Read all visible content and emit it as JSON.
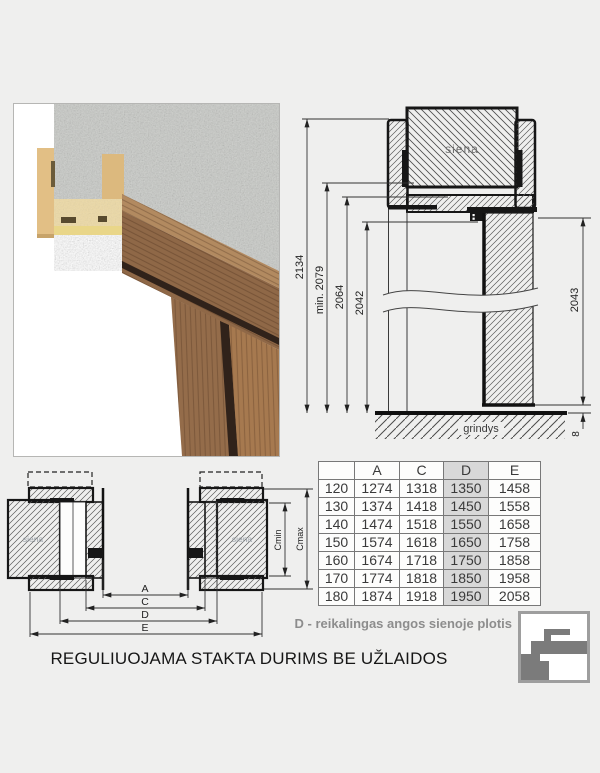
{
  "page": {
    "background": "#efefee",
    "title": "REGULIUOJAMA STAKTA DURIMS BE UŽLAIDOS",
    "note": "D - reikalingas angos sienoje plotis"
  },
  "vertical_section": {
    "wall_label": "siena",
    "floor_label": "grindys",
    "dims_left": [
      "2134",
      "min. 2079",
      "2064",
      "2042"
    ],
    "dim_door_height": "2043",
    "dim_floor_gap": "8"
  },
  "horizontal_section": {
    "wall_label_left": "siena",
    "wall_label_right": "siena",
    "dim_a": "A",
    "dim_c": "C",
    "dim_d": "D",
    "dim_e": "E",
    "dim_cmin": "Cmin",
    "dim_cmax": "Cmax"
  },
  "table": {
    "headers": [
      "",
      "A",
      "C",
      "D",
      "E"
    ],
    "highlight_col_index": 3,
    "highlight_color": "#d8d8d8",
    "rows": [
      [
        "120",
        "1274",
        "1318",
        "1350",
        "1458"
      ],
      [
        "130",
        "1374",
        "1418",
        "1450",
        "1558"
      ],
      [
        "140",
        "1474",
        "1518",
        "1550",
        "1658"
      ],
      [
        "150",
        "1574",
        "1618",
        "1650",
        "1758"
      ],
      [
        "160",
        "1674",
        "1718",
        "1750",
        "1858"
      ],
      [
        "170",
        "1774",
        "1818",
        "1850",
        "1958"
      ],
      [
        "180",
        "1874",
        "1918",
        "1950",
        "2058"
      ]
    ]
  }
}
